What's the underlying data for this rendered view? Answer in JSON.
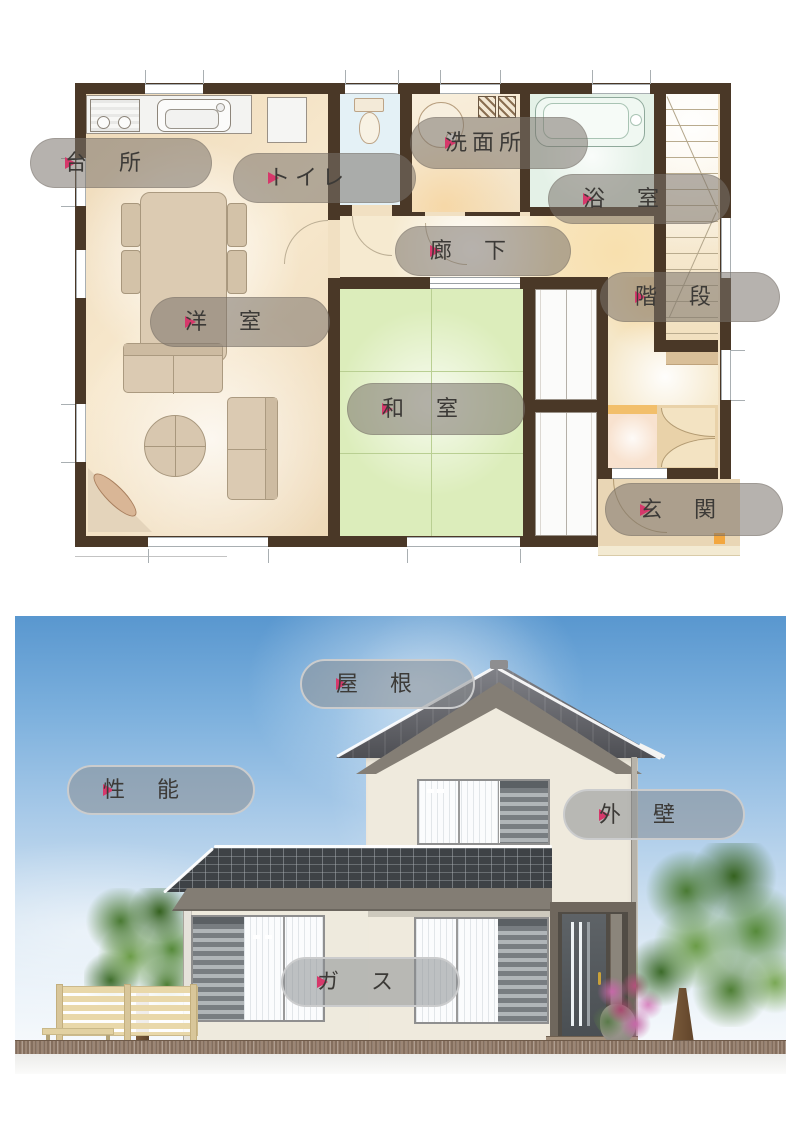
{
  "colors": {
    "arrow": "#d6386b",
    "wall": "#4a3827",
    "tatami": "#dcedbb",
    "bath": "#e4f1e7",
    "toilet": "#e4f1f6",
    "skytop": "#5997cf",
    "roof": "#4e4f54",
    "orange": "#f2bf6b"
  },
  "floor_plan": {
    "labels": [
      {
        "id": "kitchen",
        "text": "台　所"
      },
      {
        "id": "toilet",
        "text": "トイレ"
      },
      {
        "id": "washroom",
        "text": "洗面所"
      },
      {
        "id": "bathroom",
        "text": "浴　室"
      },
      {
        "id": "hallway",
        "text": "廊　下"
      },
      {
        "id": "stairs",
        "text": "階　段"
      },
      {
        "id": "western-room",
        "text": "洋　室"
      },
      {
        "id": "japanese-room",
        "text": "和　室"
      },
      {
        "id": "entrance",
        "text": "玄　関"
      }
    ]
  },
  "exterior": {
    "labels": [
      {
        "id": "roof",
        "text": "屋　根"
      },
      {
        "id": "performance",
        "text": "性　能"
      },
      {
        "id": "exterior-wall",
        "text": "外　壁"
      },
      {
        "id": "gas",
        "text": "ガ　ス"
      }
    ]
  }
}
